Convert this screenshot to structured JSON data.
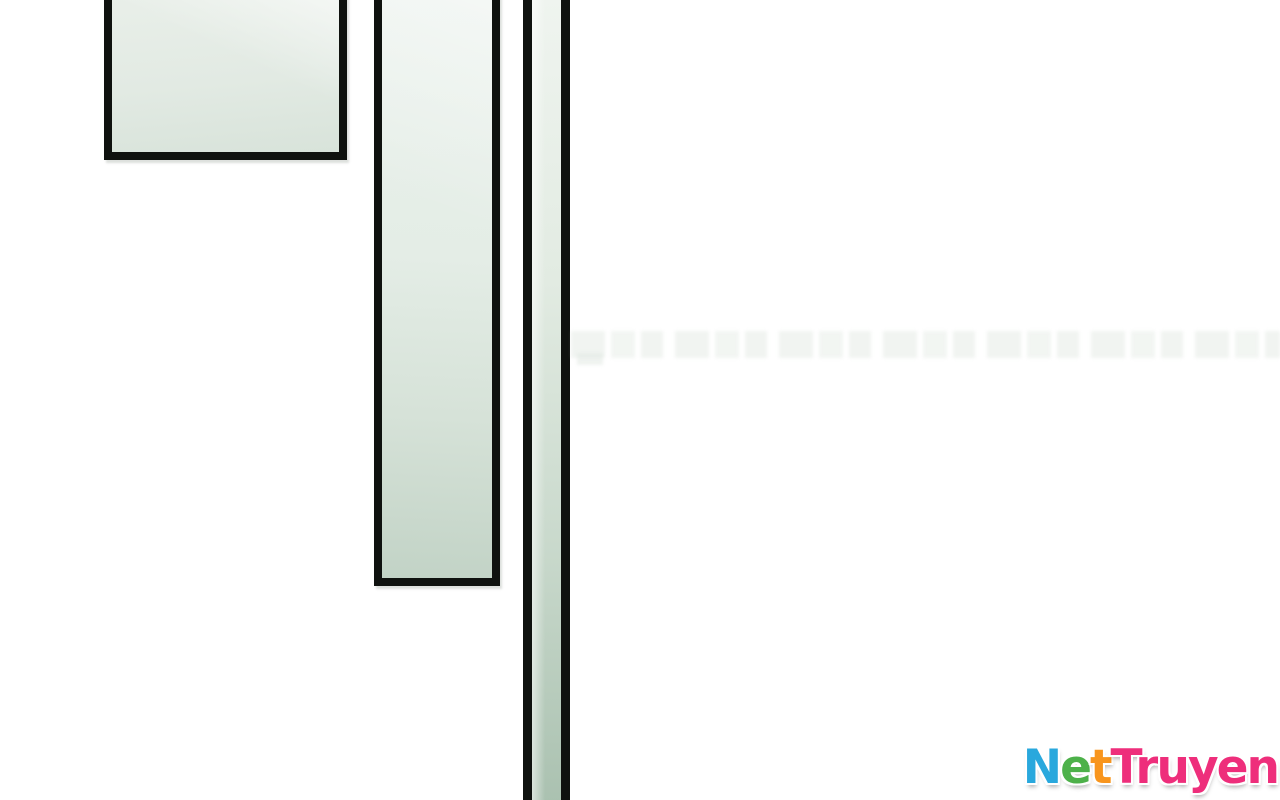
{
  "page": {
    "background_color": "#ffffff",
    "ink_color": "#0f120f",
    "description": "Comic page scan with three cropped glass-pane panels and faint watermark band"
  },
  "panels": {
    "fill_light": "#eaf1ec",
    "fill_dark": "#aac1b0",
    "border_color": "#0f120f"
  },
  "watermark": {
    "name": "NetTruyen",
    "letters": [
      {
        "ch": "N",
        "color": "#29a8dd"
      },
      {
        "ch": "e",
        "color": "#4db14a"
      },
      {
        "ch": "t",
        "color": "#f8951d"
      },
      {
        "ch": "T",
        "color": "#ee2e7b"
      },
      {
        "ch": "r",
        "color": "#ee2e7b"
      },
      {
        "ch": "u",
        "color": "#ee2e7b"
      },
      {
        "ch": "y",
        "color": "#ee2e7b"
      },
      {
        "ch": "e",
        "color": "#ee2e7b"
      },
      {
        "ch": "n",
        "color": "#ee2e7b"
      }
    ]
  }
}
